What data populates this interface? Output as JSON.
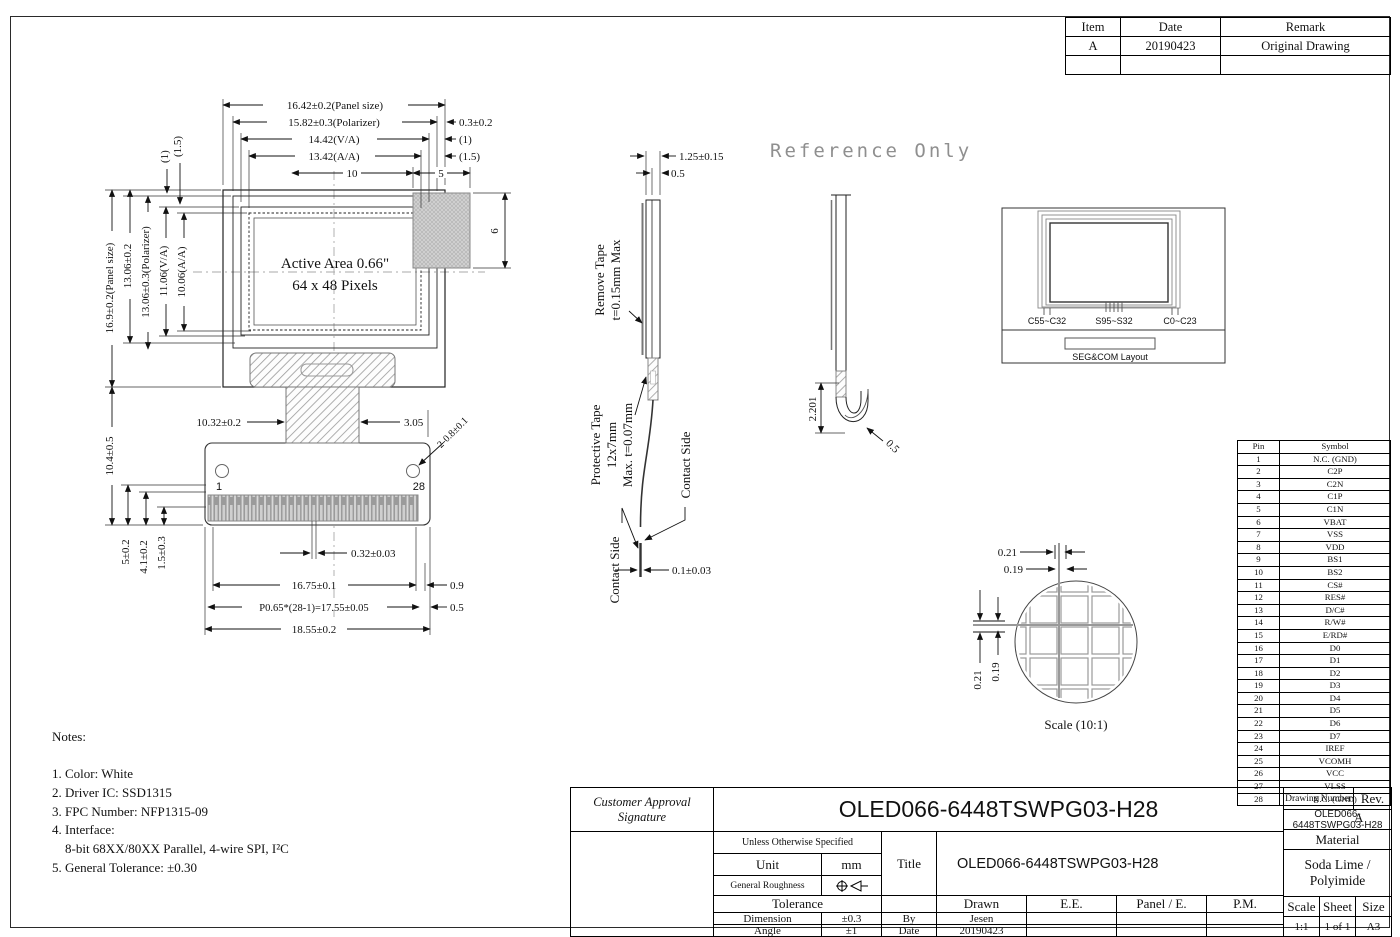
{
  "colors": {
    "line": "#1a1a1a",
    "hatch_gray": "#999999",
    "watermark_gray": "#8f8f8f"
  },
  "watermark": "Reference Only",
  "revisions": {
    "headers": [
      "Item",
      "Date",
      "Remark"
    ],
    "rows": [
      [
        "A",
        "20190423",
        "Original Drawing"
      ],
      [
        "",
        "",
        ""
      ]
    ]
  },
  "front": {
    "top": {
      "panel_w": "16.42±0.2(Panel size)",
      "pol_w": "15.82±0.3(Polarizer)",
      "va_w": "14.42(V/A)",
      "aa_w": "13.42(A/A)",
      "ten": "10",
      "five": "5",
      "d03": "0.3±0.2",
      "d1": "(1)",
      "d15": "(1.5)"
    },
    "left": {
      "d15": "(1.5)",
      "d1": "(1)",
      "panel_h": "16.9±0.2(Panel size)",
      "d1306": "13.06±0.2",
      "pol_h": "13.06±0.3(Polarizer)",
      "va_h": "11.06(V/A)",
      "aa_h": "10.06(A/A)",
      "d104": "10.4±0.5",
      "d5": "5±0.2",
      "d41": "4.1±0.2",
      "d15b": "1.5±0.3"
    },
    "area": {
      "line1": "Active Area 0.66\"",
      "line2": "64 x 48 Pixels"
    },
    "right": {
      "d6": "6"
    },
    "bottom": {
      "d1032": "10.32±0.2",
      "d305": "3.05",
      "holes": "2-0.8±0.1",
      "pin1": "1",
      "pin28": "28",
      "d032": "0.32±0.03",
      "d1675": "16.75±0.1",
      "d09": "0.9",
      "pitch": "P0.65*(28-1)=17.55±0.05",
      "d05": "0.5",
      "d1855": "18.55±0.2"
    }
  },
  "side": {
    "remove1": "Remove Tape",
    "remove2": "t=0.15mm Max",
    "d125": "1.25±0.15",
    "d05": "0.5",
    "prot1": "Protective Tape",
    "prot2": "12x7mm",
    "prot3": "Max. t=0.07mm",
    "contact_r": "Contact Side",
    "contact_l": "Contact Side",
    "d01": "0.1±0.03"
  },
  "folded": {
    "d2201": "2.201",
    "d05": "0.5"
  },
  "segcom": {
    "left": "C55~C32",
    "center": "S95~S32",
    "right": "C0~C23",
    "caption": "SEG&COM Layout"
  },
  "pixel": {
    "h021": "0.21",
    "h019": "0.19",
    "v021": "0.21",
    "v019": "0.19",
    "caption": "Scale (10:1)"
  },
  "notes": {
    "title": "Notes:",
    "lines": [
      "1. Color: White",
      "2. Driver IC: SSD1315",
      "3. FPC Number: NFP1315-09",
      "4. Interface:",
      "    8-bit 68XX/80XX Parallel, 4-wire SPI, I²C",
      "5. General Tolerance: ±0.30"
    ]
  },
  "pins": {
    "headers": [
      "Pin",
      "Symbol"
    ],
    "rows": [
      [
        "1",
        "N.C. (GND)"
      ],
      [
        "2",
        "C2P"
      ],
      [
        "3",
        "C2N"
      ],
      [
        "4",
        "C1P"
      ],
      [
        "5",
        "C1N"
      ],
      [
        "6",
        "VBAT"
      ],
      [
        "7",
        "VSS"
      ],
      [
        "8",
        "VDD"
      ],
      [
        "9",
        "BS1"
      ],
      [
        "10",
        "BS2"
      ],
      [
        "11",
        "CS#"
      ],
      [
        "12",
        "RES#"
      ],
      [
        "13",
        "D/C#"
      ],
      [
        "14",
        "R/W#"
      ],
      [
        "15",
        "E/RD#"
      ],
      [
        "16",
        "D0"
      ],
      [
        "17",
        "D1"
      ],
      [
        "18",
        "D2"
      ],
      [
        "19",
        "D3"
      ],
      [
        "20",
        "D4"
      ],
      [
        "21",
        "D5"
      ],
      [
        "22",
        "D6"
      ],
      [
        "23",
        "D7"
      ],
      [
        "24",
        "IREF"
      ],
      [
        "25",
        "VCOMH"
      ],
      [
        "26",
        "VCC"
      ],
      [
        "27",
        "VLSS"
      ],
      [
        "28",
        "N.C. (GND)"
      ]
    ]
  },
  "titleblock": {
    "customer_approval": "Customer Approval",
    "signature": "Signature",
    "product_name": "OLED066-6448TSWPG03-H28",
    "drawing_number_label": "Drawing Number",
    "rev_label": "Rev.",
    "drawing_number_value": "OLED066-6448TSWPG03-H28",
    "rev_value": "A",
    "material_label": "Material",
    "material_value": "Soda Lime / Polyimide",
    "unless": "Unless Otherwise Specified",
    "unit_label": "Unit",
    "unit_value": "mm",
    "roughness_label": "General Roughness",
    "roughness_icon": "surface-roughness-symbol",
    "title_label": "Title",
    "title_value": "OLED066-6448TSWPG03-H28",
    "tolerance_label": "Tolerance",
    "drawn_label": "Drawn",
    "ee_label": "E.E.",
    "panel_e_label": "Panel / E.",
    "pm_label": "P.M.",
    "dimension_label": "Dimension",
    "dimension_value": "±0.3",
    "by_label": "By",
    "by_value": "Jesen",
    "angle_label": "Angle",
    "angle_value": "±1",
    "date_label": "Date",
    "date_value": "20190423",
    "scale_label": "Scale",
    "scale_value": "1:1",
    "sheet_label": "Sheet",
    "sheet_value": "1 of 1",
    "size_label": "Size",
    "size_value": "A3"
  }
}
